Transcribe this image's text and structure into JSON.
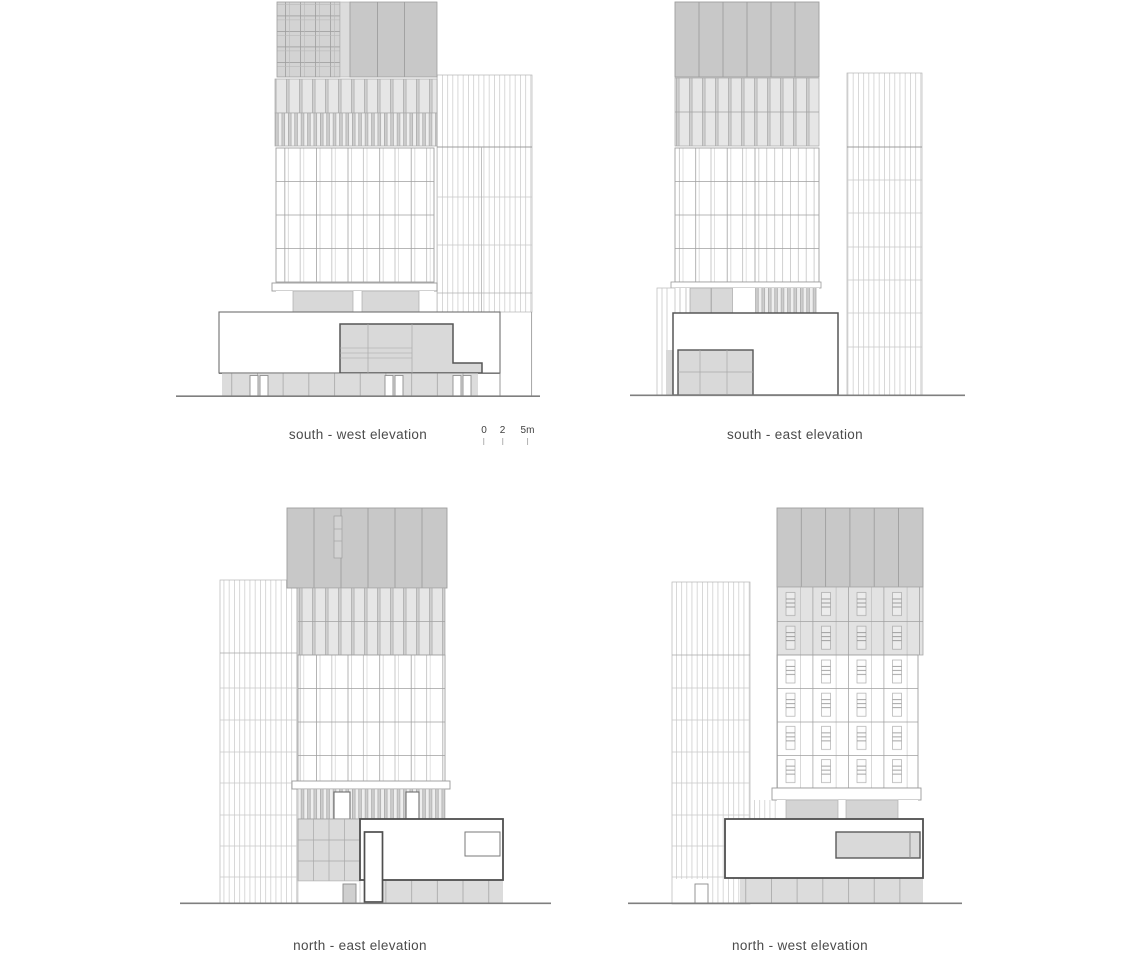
{
  "sheet": {
    "type": "architectural elevation drawing sheet",
    "elevation_count": 4
  },
  "labels": {
    "south_west": "south - west elevation",
    "south_east": "south - east elevation",
    "north_east": "north - east elevation",
    "north_west": "north - west elevation"
  },
  "scale_bar": {
    "unit": "m",
    "ticks": [
      "0",
      "2",
      "5m"
    ]
  },
  "colors": {
    "background": "#ffffff",
    "roof_block_gray": "#c8c8c8",
    "facade_band_gray": "#e6e6e6",
    "podium_gray": "#d9d9d9",
    "thin_line_gray": "#9e9e9e",
    "bold_outline": "#4f4f4f",
    "label_text": "#4b4b4b"
  }
}
